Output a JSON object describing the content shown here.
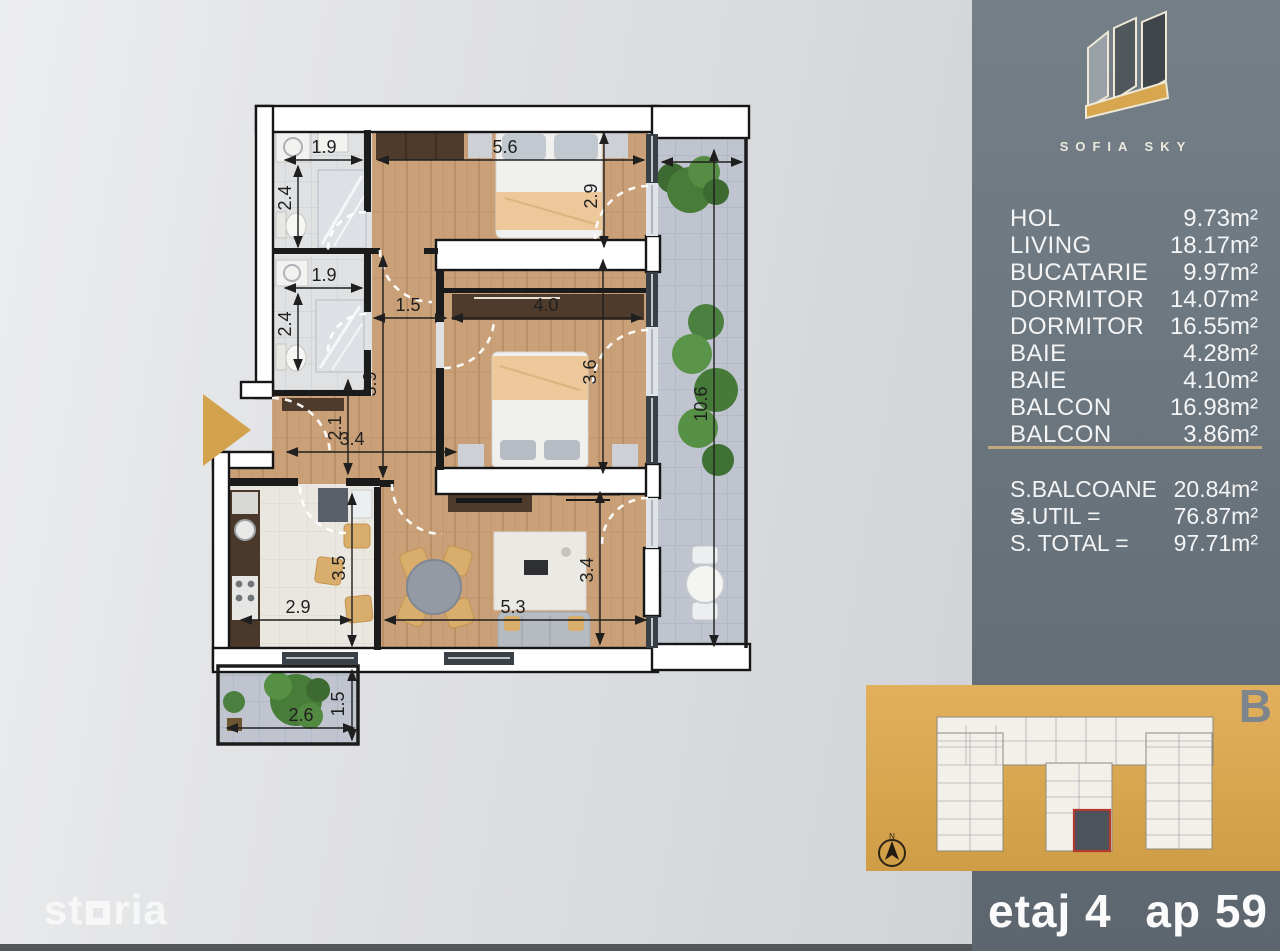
{
  "page": {
    "watermark": "storia"
  },
  "logo": {
    "title": "SOFIA SKY"
  },
  "sidebar": {
    "rooms": [
      {
        "name": "HOL",
        "area": "9.73m²"
      },
      {
        "name": "LIVING",
        "area": "18.17m²"
      },
      {
        "name": "BUCATARIE",
        "area": "9.97m²"
      },
      {
        "name": "DORMITOR",
        "area": "14.07m²"
      },
      {
        "name": "DORMITOR",
        "area": "16.55m²"
      },
      {
        "name": "BAIE",
        "area": "4.28m²"
      },
      {
        "name": "BAIE",
        "area": "4.10m²"
      },
      {
        "name": "BALCON",
        "area": "16.98m²"
      },
      {
        "name": "BALCON",
        "area": "3.86m²"
      }
    ],
    "totals": [
      {
        "label": "S.BALCOANE =",
        "value": "20.84m²"
      },
      {
        "label": "S.UTIL =",
        "value": "76.87m²"
      },
      {
        "label": "S. TOTAL =",
        "value": "97.71m²"
      }
    ]
  },
  "keyplan": {
    "block_letter": "B",
    "compass_label": "N"
  },
  "footer": {
    "floor": "etaj 4",
    "apartment": "ap 59"
  },
  "colors": {
    "accent_gold": "#d7a64f",
    "sidebar": "#6b757d",
    "separator": "#bfa87c"
  },
  "plan": {
    "dimensions": [
      {
        "label": "1.9",
        "x": 324,
        "y": 153,
        "rot": 0
      },
      {
        "label": "2.4",
        "x": 291,
        "y": 198,
        "rot": -90
      },
      {
        "label": "1.9",
        "x": 324,
        "y": 281,
        "rot": 0
      },
      {
        "label": "2.4",
        "x": 291,
        "y": 324,
        "rot": -90
      },
      {
        "label": "5.6",
        "x": 505,
        "y": 153,
        "rot": 0
      },
      {
        "label": "2.9",
        "x": 597,
        "y": 196,
        "rot": -90
      },
      {
        "label": "1.5",
        "x": 408,
        "y": 311,
        "rot": 0
      },
      {
        "label": "4.0",
        "x": 546,
        "y": 311,
        "rot": 0
      },
      {
        "label": "3.6",
        "x": 596,
        "y": 372,
        "rot": -90
      },
      {
        "label": "3.9",
        "x": 376,
        "y": 384,
        "rot": -90
      },
      {
        "label": "2.1",
        "x": 341,
        "y": 428,
        "rot": -90
      },
      {
        "label": "3.4",
        "x": 352,
        "y": 445,
        "rot": 0
      },
      {
        "label": "3.5",
        "x": 345,
        "y": 568,
        "rot": -90
      },
      {
        "label": "2.9",
        "x": 298,
        "y": 613,
        "rot": 0
      },
      {
        "label": "5.3",
        "x": 513,
        "y": 613,
        "rot": 0
      },
      {
        "label": "3.4",
        "x": 593,
        "y": 570,
        "rot": -90
      },
      {
        "label": "10.6",
        "x": 707,
        "y": 404,
        "rot": -90
      },
      {
        "label": "2.6",
        "x": 301,
        "y": 721,
        "rot": 0
      },
      {
        "label": "1.5",
        "x": 344,
        "y": 704,
        "rot": -90
      }
    ]
  }
}
